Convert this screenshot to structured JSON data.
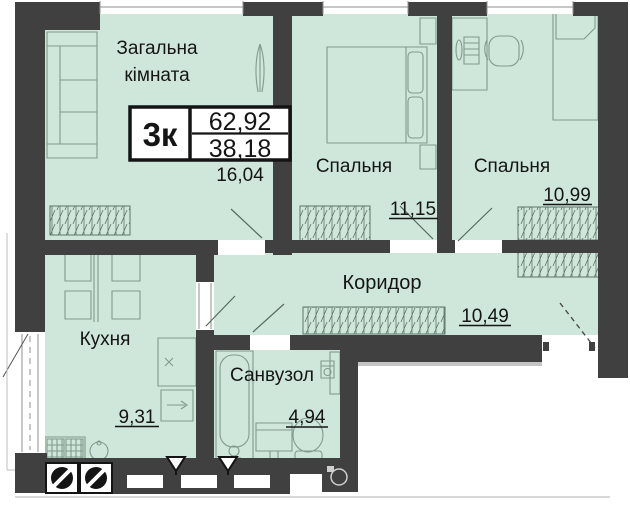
{
  "plan": {
    "unit_label": "3к",
    "areas": {
      "total": "62,92",
      "living": "38,18"
    },
    "rooms": [
      {
        "id": "living-room",
        "name": "Загальна кімната",
        "name_line1": "Загальна",
        "name_line2": "кімната",
        "area": "16,04"
      },
      {
        "id": "bedroom-1",
        "name": "Спальня",
        "area": "11,15"
      },
      {
        "id": "bedroom-2",
        "name": "Спальня",
        "area": "10,99"
      },
      {
        "id": "kitchen",
        "name": "Кухня",
        "area": "9,31"
      },
      {
        "id": "corridor",
        "name": "Коридор",
        "area": "10,49"
      },
      {
        "id": "bathroom",
        "name": "Санвузол",
        "area": "4,94"
      }
    ],
    "colors": {
      "room_fill": "#cfe7da",
      "wall": "#3f403f",
      "furniture_line": "#7f9a8c",
      "text": "#151515",
      "hatch": "#5d7468",
      "window_white": "#ffffff"
    }
  }
}
